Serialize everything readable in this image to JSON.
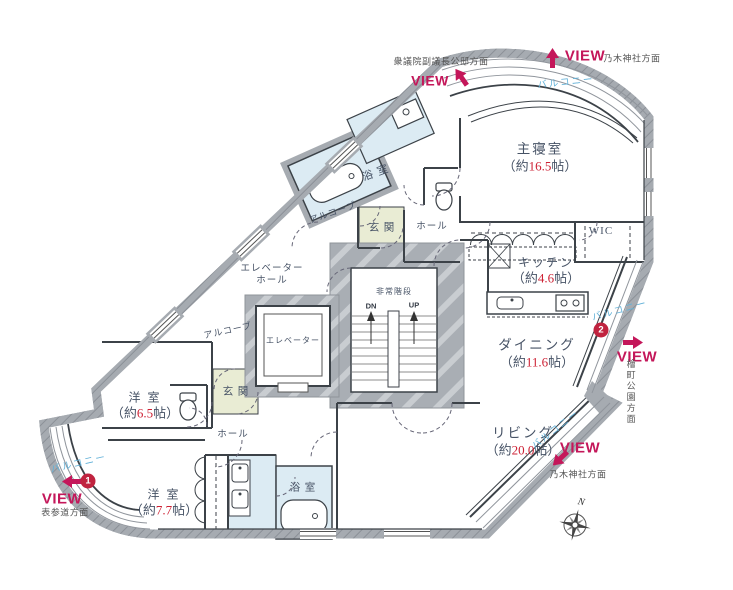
{
  "plan": {
    "rooms": {
      "master_bedroom": {
        "name": "主寝室",
        "size_prefix": "（約",
        "size_value": "16.5",
        "size_suffix": "帖）"
      },
      "wic": {
        "name": "WIC"
      },
      "kitchen": {
        "name": "キッチン",
        "size_prefix": "（約",
        "size_value": "4.6",
        "size_suffix": "帖）"
      },
      "dining": {
        "name": "ダイニング",
        "size_prefix": "（約",
        "size_value": "11.6",
        "size_suffix": "帖）"
      },
      "living": {
        "name": "リビング",
        "size_prefix": "（約",
        "size_value": "20.0",
        "size_suffix": "帖）"
      },
      "western_room_6_5": {
        "name": "洋 室",
        "size_prefix": "（約",
        "size_value": "6.5",
        "size_suffix": "帖）"
      },
      "western_room_7_7": {
        "name": "洋 室",
        "size_prefix": "（約",
        "size_value": "7.7",
        "size_suffix": "帖）"
      },
      "bathroom_upper": {
        "name": "浴 室"
      },
      "bathroom_lower": {
        "name": "浴 室"
      },
      "entrance_upper": {
        "name": "玄 関"
      },
      "entrance_lower": {
        "name": "玄 関"
      },
      "hall_upper": {
        "name": "ホール"
      },
      "hall_lower": {
        "name": "ホール"
      },
      "elevator_hall": {
        "line1": "エレベーター",
        "line2": "ホール"
      },
      "elevator": {
        "name": "エレベーター"
      },
      "emergency_stairs": {
        "name": "非常階段",
        "down": "DN",
        "up": "UP"
      },
      "alcove_upper": {
        "name": "アルコーブ"
      },
      "alcove_lower": {
        "name": "アルコーブ"
      }
    },
    "balconies": {
      "top": "バルコニー",
      "right": "バルコニー",
      "bottom_right": "バルコニー",
      "bottom_left": "バルコニー"
    },
    "views": {
      "top_left": {
        "label": "VIEW",
        "direction": "衆議院副議長公邸方面"
      },
      "top": {
        "label": "VIEW",
        "direction": "乃木神社方面"
      },
      "right": {
        "label": "VIEW",
        "direction": "檜町公園方面",
        "marker": "2"
      },
      "bottom_right": {
        "label": "VIEW",
        "direction": "乃木神社方面"
      },
      "bottom_left": {
        "label": "VIEW",
        "direction": "表参道方面",
        "marker": "1"
      }
    },
    "compass": {
      "north": "N"
    },
    "colors": {
      "view_red": "#c4175a",
      "area_number_red": "#cd2134",
      "balcony_text_blue": "#62b1d8",
      "wet_area_fill": "#dcebf3",
      "entrance_fill": "#e9ecd4",
      "wall_fill": "#a6abb1",
      "room_text": "#475366"
    }
  }
}
